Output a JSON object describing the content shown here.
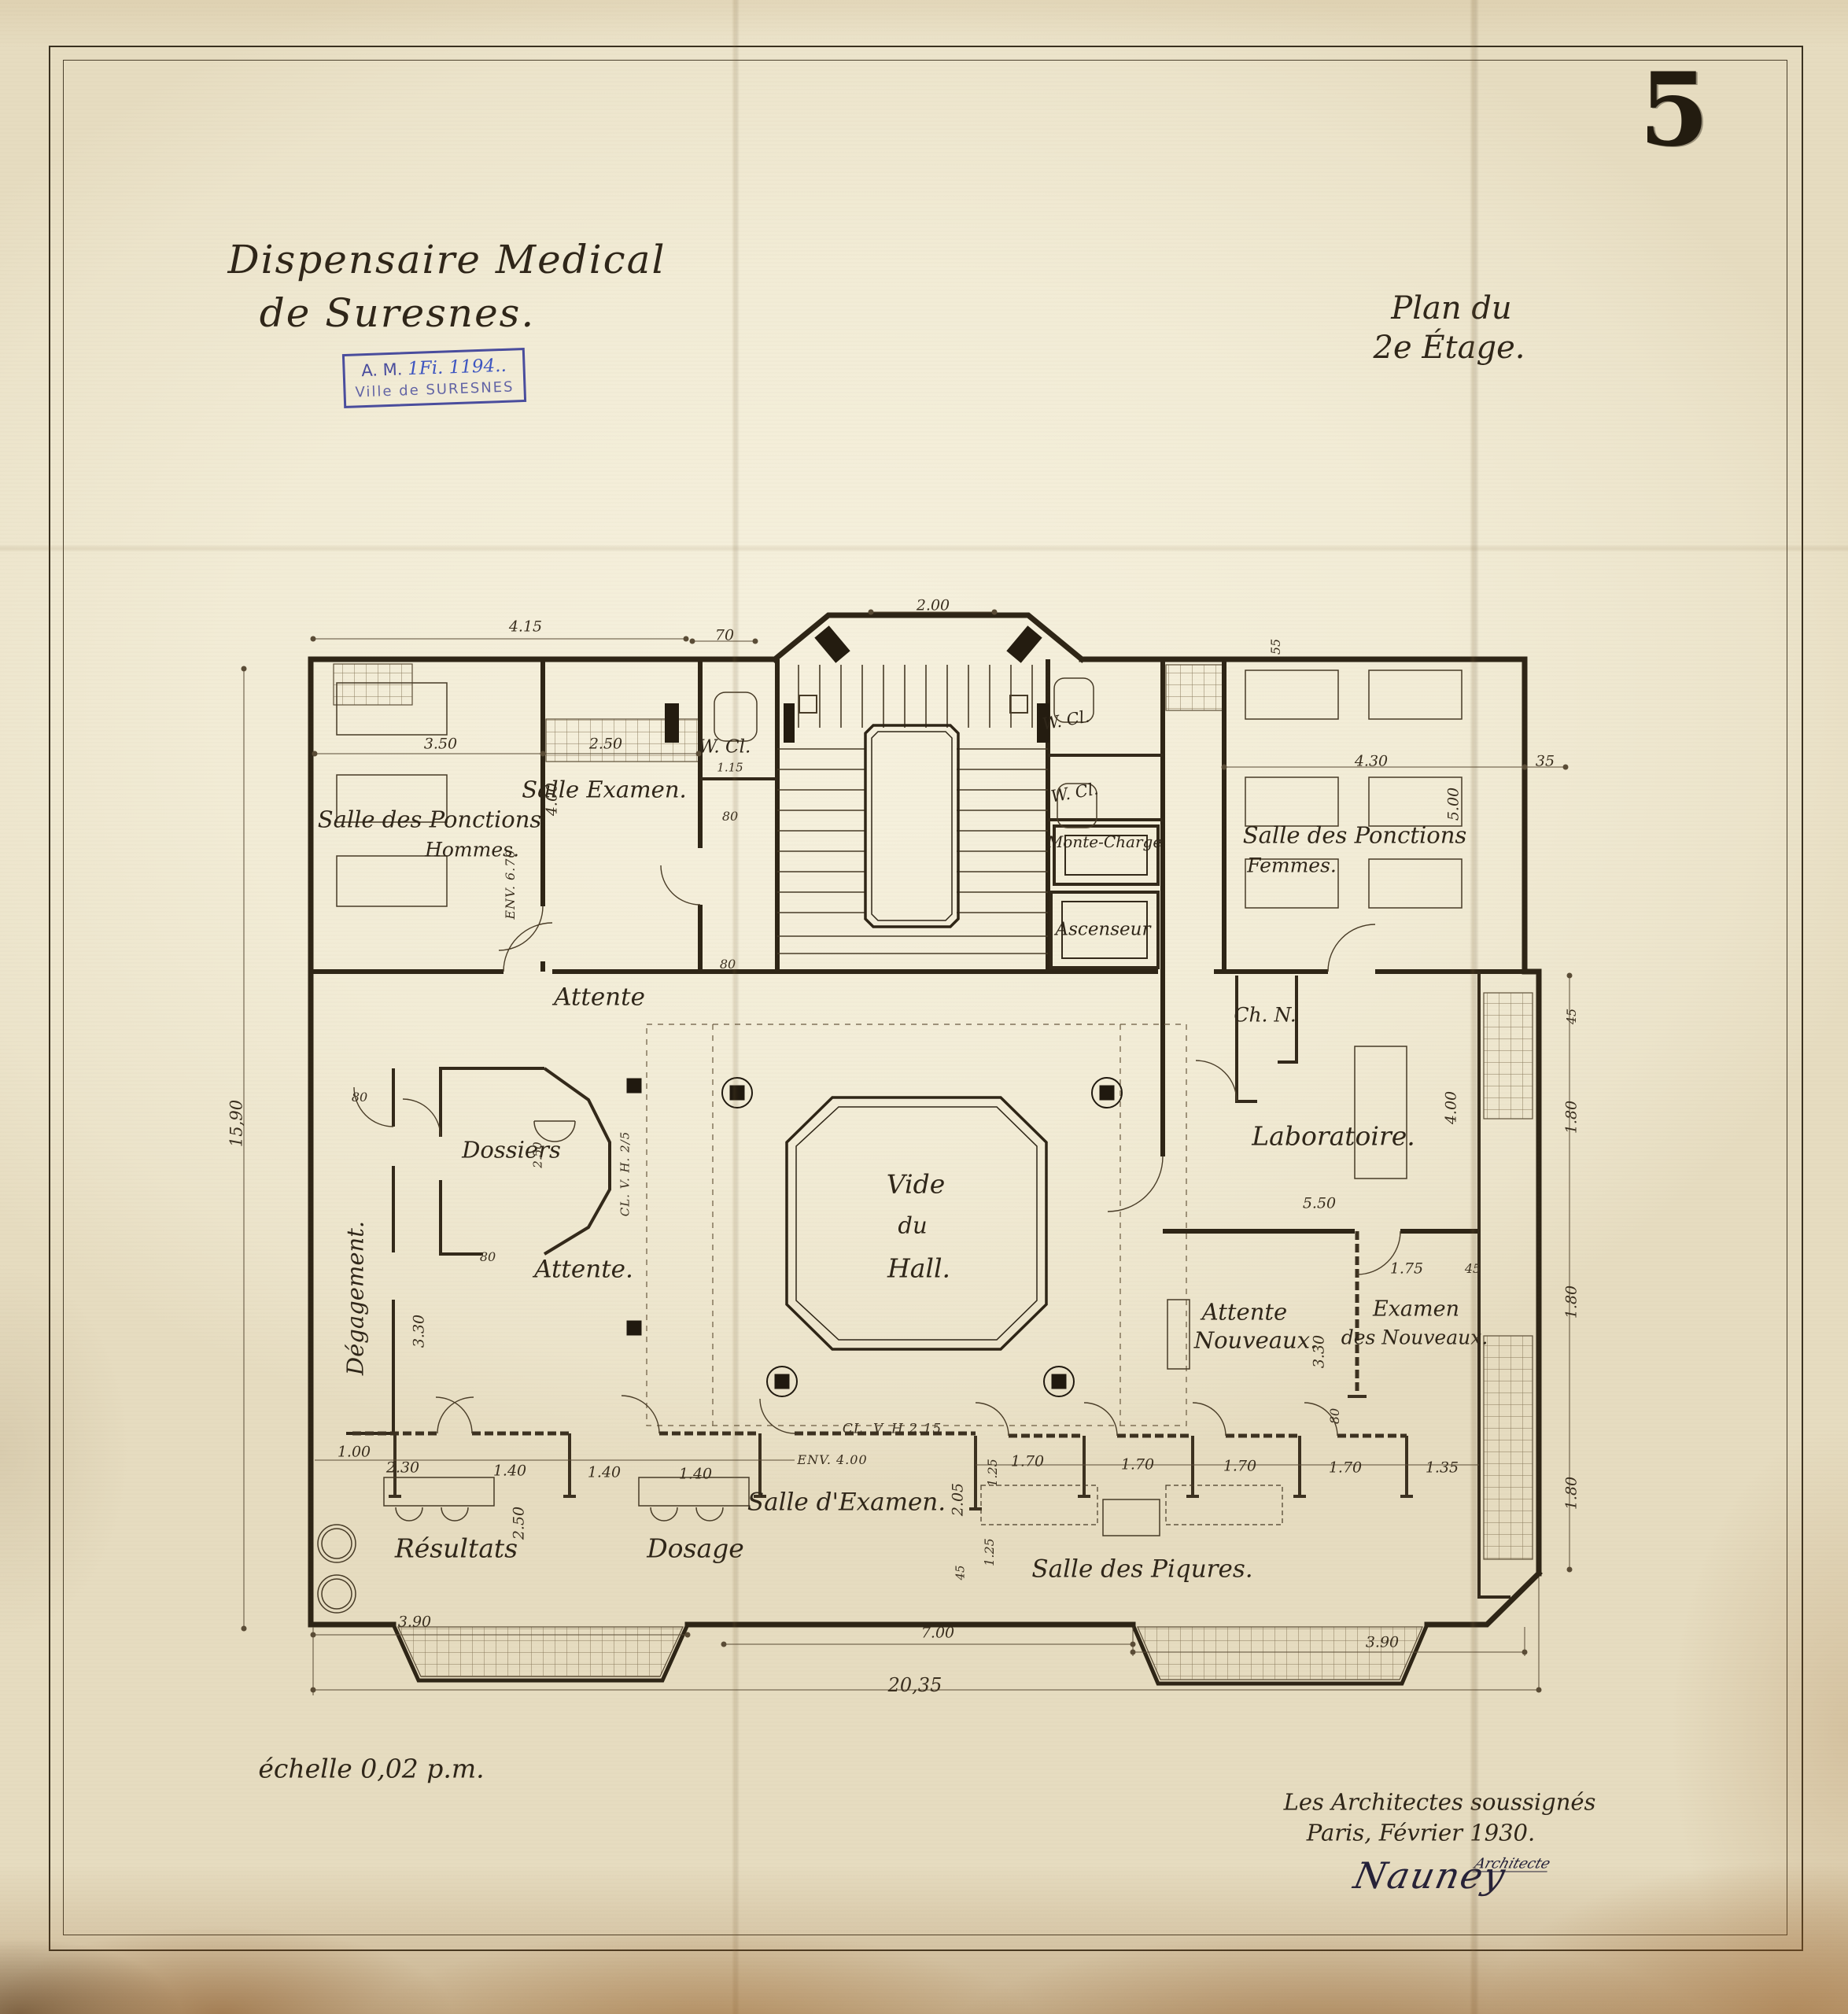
{
  "sheet": {
    "number": "5"
  },
  "title": {
    "line1": "Dispensaire Medical",
    "line2": "de Suresnes."
  },
  "archive_stamp": {
    "prefix": "A. M.",
    "reference": "1Fi. 1194..",
    "city": "Ville de SURESNES"
  },
  "plan_title": {
    "line1": "Plan du",
    "line2": "2e Étage."
  },
  "scale_note": "échelle 0,02 p.m.",
  "signature_block": {
    "line1": "Les Architectes soussignés",
    "line2": "Paris, Février 1930.",
    "signature": "Nauney",
    "countersign": "Architecte"
  },
  "rooms": {
    "ponctions_hommes_1": "Salle des Ponctions",
    "ponctions_hommes_2": "Hommes.",
    "salle_examen": "Salle Examen.",
    "wc_left": "W. Cl.",
    "wc_left_dim": "1.15",
    "wc_right_top": "W. Cl.",
    "wc_right_mid": "W. Cl.",
    "monte_charge": "Monte-Charge",
    "ascenseur": "Ascenseur",
    "ponctions_femmes_1": "Salle des Ponctions",
    "ponctions_femmes_2": "Femmes.",
    "attente_upper": "Attente",
    "ch_n": "Ch. N.",
    "laboratoire": "Laboratoire.",
    "dossiers": "Dossiers",
    "dossiers_dim": "2.50",
    "vide_1": "Vide",
    "vide_2": "du",
    "vide_3": "Hall.",
    "degagement": "Dégagement.",
    "attente_lower": "Attente.",
    "attente_nouveaux_1": "Attente",
    "attente_nouveaux_2": "Nouveaux.",
    "examen_nouveaux_1": "Examen",
    "examen_nouveaux_2": "des Nouveaux.",
    "salle_d_examen": "Salle d'Examen.",
    "resultats": "Résultats",
    "dosage": "Dosage",
    "salle_piqures": "Salle des Piqures."
  },
  "annotations": {
    "clv_bay": "CL. V. H. 2/5",
    "clv_wall": "CL. V. H 2.15",
    "env_4": "ENV. 4.00",
    "env_670": "ENV. 6.70"
  },
  "dims": {
    "d415": "4.15",
    "d70": "70",
    "d200": "2.00",
    "d1590": "15,90",
    "d350": "3.50",
    "d250a": "2.50",
    "d400a": "4.00",
    "d80a": "80",
    "d80b": "80",
    "d80c": "80",
    "d80d": "80",
    "d330l": "3.30",
    "d55": "55",
    "d430": "4.30",
    "d500": "5.00",
    "d35": "35",
    "d45a": "45",
    "d180a": "1.80",
    "d400b": "4.00",
    "d550": "5.50",
    "d175": "1.75",
    "d45b": "45",
    "d330r": "3.30",
    "d80e": "80",
    "d180b": "1.80",
    "d180c": "1.80",
    "d100": "1.00",
    "d230": "2.30",
    "d140a": "1.40",
    "d140b": "1.40",
    "d140c": "1.40",
    "d250b": "2.50",
    "d205": "2.05",
    "d125a": "1.25",
    "d170a": "1.70",
    "d170b": "1.70",
    "d170c": "1.70",
    "d170d": "1.70",
    "d135": "1.35",
    "d125b": "1.25",
    "d45c": "45",
    "d390a": "3.90",
    "d700": "7.00",
    "d390b": "3.90",
    "d2035": "20,35"
  }
}
